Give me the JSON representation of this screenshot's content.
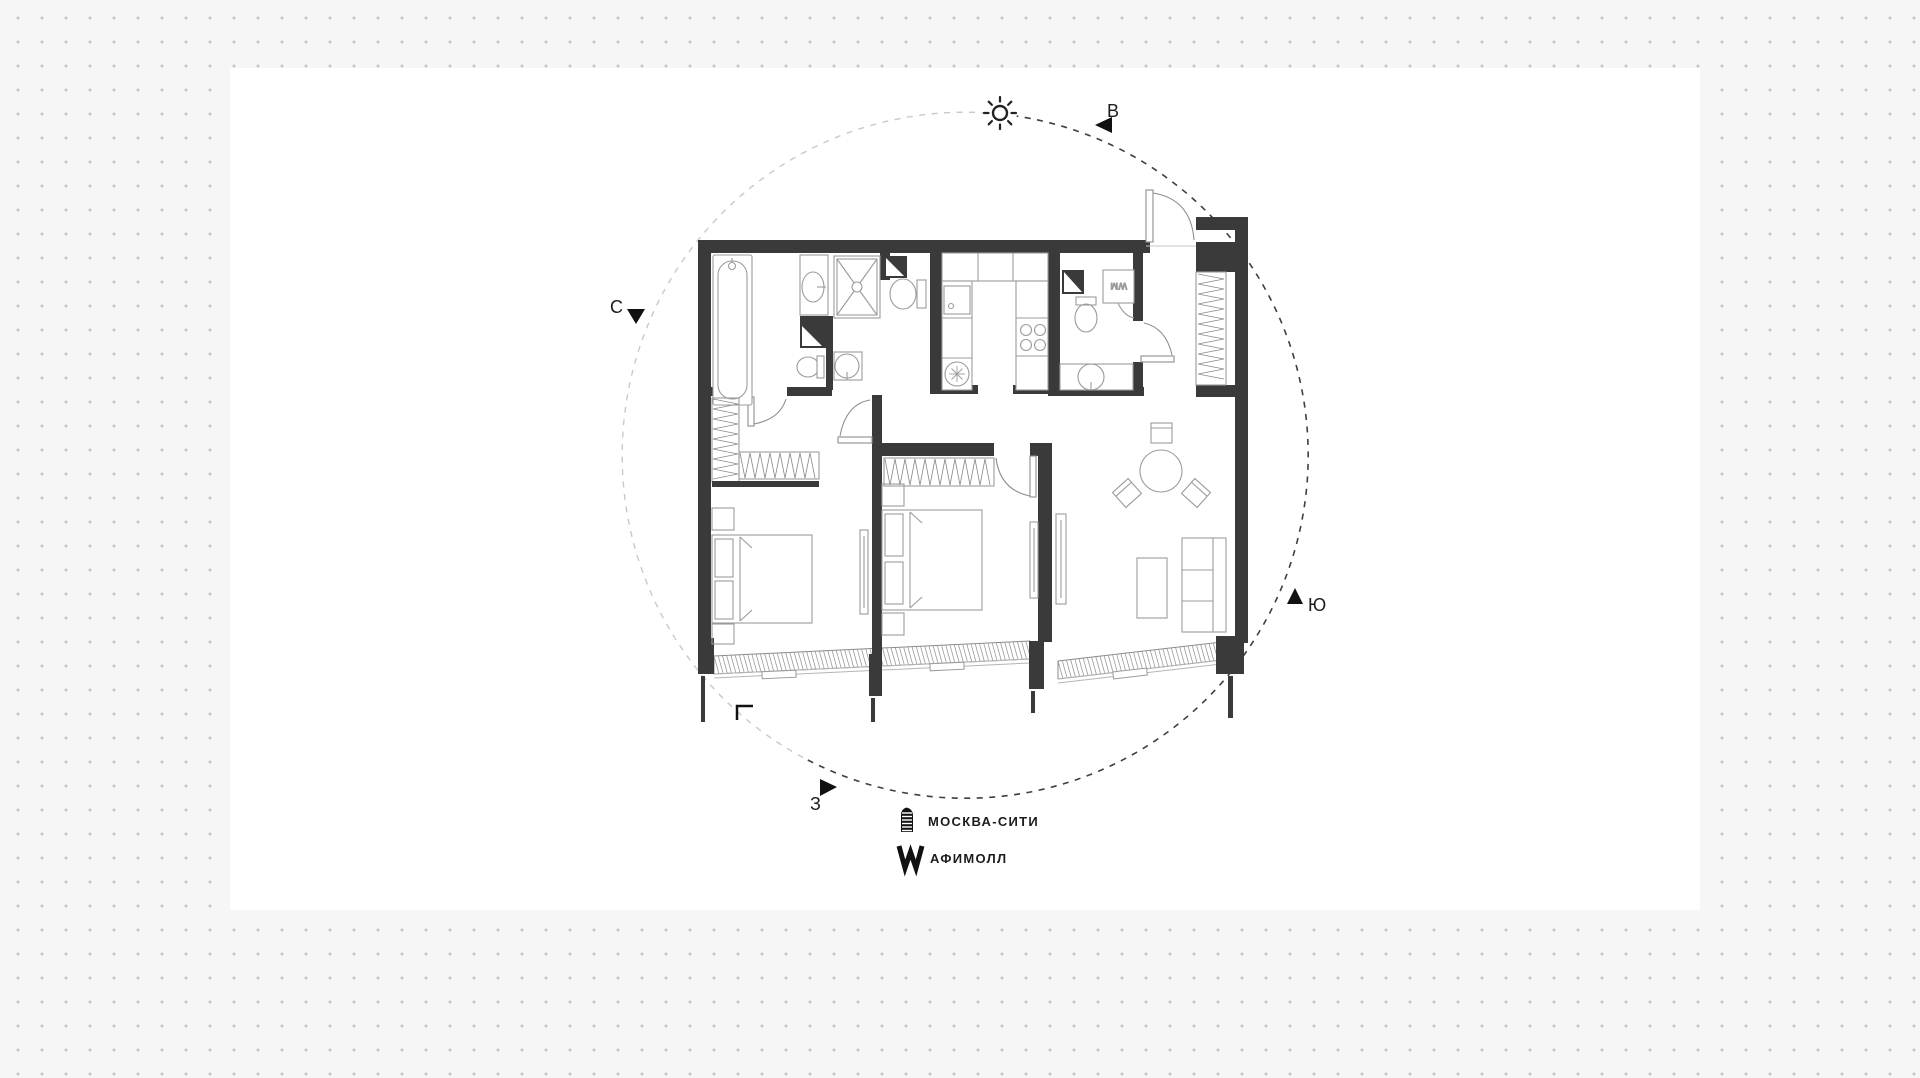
{
  "compass": {
    "east_label": "В",
    "north_label": "С",
    "south_label": "Ю",
    "west_label": "З"
  },
  "legend": {
    "items": [
      {
        "icon": "moscow-city-tower-icon",
        "label": "МОСКВА-СИТИ"
      },
      {
        "icon": "afimall-w-icon",
        "label": "АФИМОЛЛ"
      }
    ]
  },
  "floor_plan": {
    "washing_machine_label": "WM"
  },
  "colors": {
    "wall": "#3a3a3a",
    "furniture_line": "#9b9b9b",
    "dash_circle_dark": "#3f3f3f",
    "dash_circle_light": "#c9c9c9",
    "background_dot": "#c6c6c6",
    "panel": "#ffffff",
    "page_background": "#f6f6f6",
    "text": "#1c1c1c"
  }
}
